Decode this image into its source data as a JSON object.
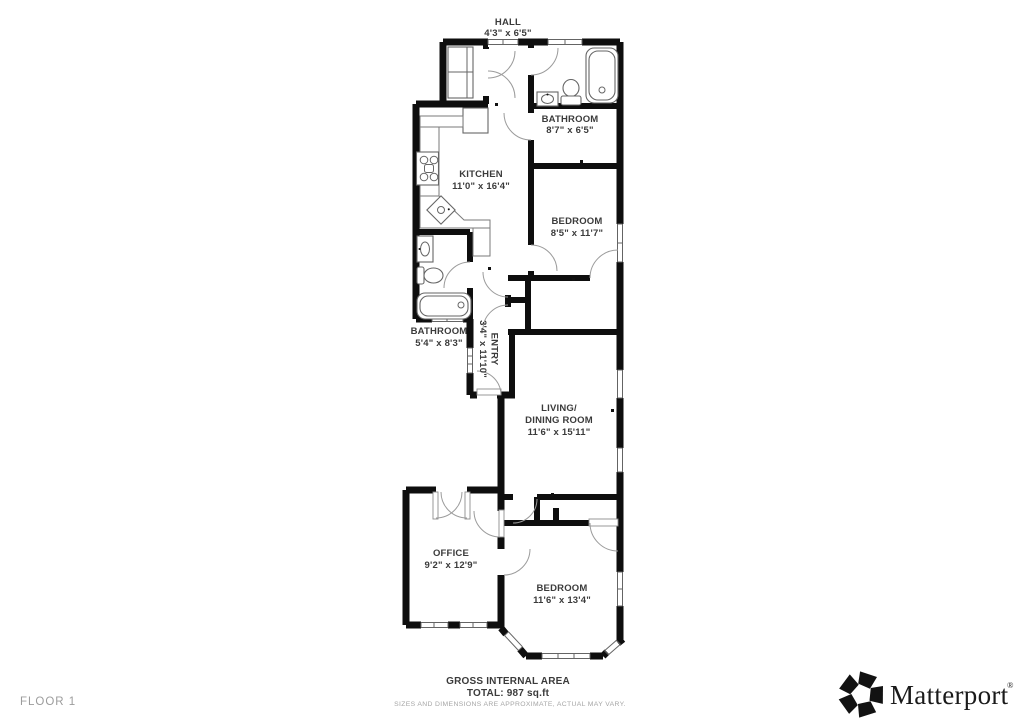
{
  "floorplan": {
    "rooms": {
      "hall": {
        "name": "HALL",
        "dims": "4'3\" x 6'5\""
      },
      "bathroom_top": {
        "name": "BATHROOM",
        "dims": "8'7\" x 6'5\""
      },
      "kitchen": {
        "name": "KITCHEN",
        "dims": "11'0\" x 16'4\""
      },
      "bedroom_top": {
        "name": "BEDROOM",
        "dims": "8'5\" x 11'7\""
      },
      "bathroom_mid": {
        "name": "BATHROOM",
        "dims": "5'4\" x 8'3\""
      },
      "entry": {
        "name": "ENTRY",
        "dims": "3'4\" x 11'10\""
      },
      "living_dining": {
        "name_line1": "LIVING/",
        "name_line2": "DINING ROOM",
        "dims": "11'6\" x 15'11\""
      },
      "office": {
        "name": "OFFICE",
        "dims": "9'2\" x 12'9\""
      },
      "bedroom_bottom": {
        "name": "BEDROOM",
        "dims": "11'6\" x 13'4\""
      }
    },
    "colors": {
      "wall": "#0e0e0e",
      "label_text": "#3b3b3b",
      "door_arc": "#9b9b9b",
      "fixture": "#666666",
      "footer_gray": "#a6a6a6"
    }
  },
  "footer": {
    "floor_label": "FLOOR 1",
    "area_title": "GROSS INTERNAL AREA",
    "area_total": "TOTAL: 987 sq.ft",
    "disclaimer": "SIZES AND DIMENSIONS ARE APPROXIMATE, ACTUAL MAY VARY.",
    "brand_name": "Matterport",
    "brand_mark": "®"
  }
}
